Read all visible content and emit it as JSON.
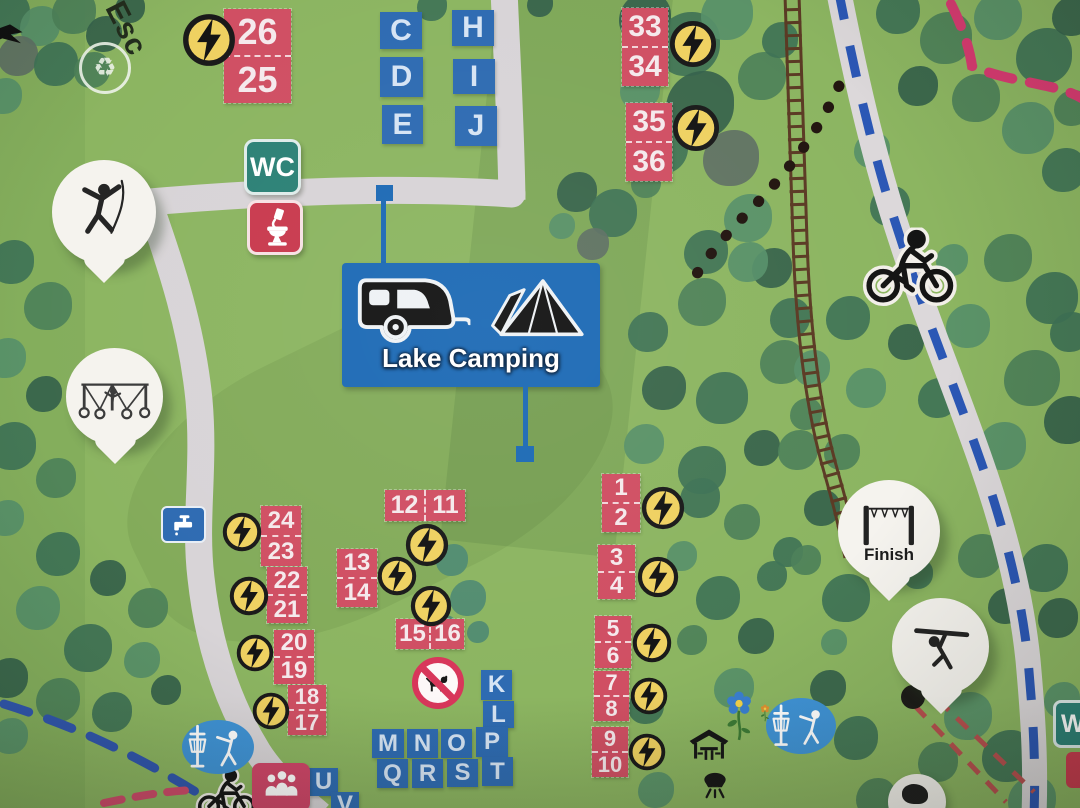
{
  "signs": {
    "lake_camping": "Lake Camping",
    "wc": "WC",
    "wc_partial": "W",
    "finish": "Finish",
    "esc": "Esc"
  },
  "colors": {
    "grass": "#8cb561",
    "path_grey": "#d8d4d7",
    "cycle_blue": "#2b57b5",
    "rail_brown": "#5b3a24",
    "pitch_red": "#d04f63",
    "letter_blue": "#2e6bb2",
    "sign_blue": "#1d6ab5",
    "wc_teal": "#2c8176",
    "toilet_red": "#c93a4e",
    "bolt_yellow": "#efd161",
    "pin_white": "#f5f3ee",
    "trail_pink": "#d63a70",
    "dash_blue": "#3056ae",
    "zip_red": "#b8504f",
    "disc_blue": "#3f93d6",
    "people_pink": "#cf4568",
    "tree_palette": [
      "#4d8159",
      "#3f7356",
      "#579069",
      "#35624b",
      "#5e7064",
      "#4e8a72",
      "#6aa36b"
    ]
  },
  "pitch_groups": [
    {
      "numbers": [
        "26",
        "25"
      ],
      "layout": "v",
      "x": 224,
      "y": 9,
      "w": 67,
      "cell_h": 46,
      "font": 36,
      "bolt": {
        "x": 182,
        "y": 13,
        "d": 54
      }
    },
    {
      "numbers": [
        "33",
        "34"
      ],
      "layout": "v",
      "x": 622,
      "y": 8,
      "w": 46,
      "cell_h": 38,
      "font": 30,
      "bolt": {
        "x": 669,
        "y": 20,
        "d": 48
      }
    },
    {
      "numbers": [
        "35",
        "36"
      ],
      "layout": "v",
      "x": 626,
      "y": 103,
      "w": 46,
      "cell_h": 38,
      "font": 30,
      "bolt": {
        "x": 672,
        "y": 104,
        "d": 48
      }
    },
    {
      "numbers": [
        "24",
        "23"
      ],
      "layout": "v",
      "x": 261,
      "y": 506,
      "w": 40,
      "cell_h": 29,
      "font": 24,
      "bolt": {
        "x": 222,
        "y": 512,
        "d": 40
      }
    },
    {
      "numbers": [
        "22",
        "21"
      ],
      "layout": "v",
      "x": 267,
      "y": 567,
      "w": 40,
      "cell_h": 27,
      "font": 24,
      "bolt": {
        "x": 229,
        "y": 576,
        "d": 40
      }
    },
    {
      "numbers": [
        "20",
        "19"
      ],
      "layout": "v",
      "x": 274,
      "y": 630,
      "w": 40,
      "cell_h": 26,
      "font": 24,
      "bolt": {
        "x": 236,
        "y": 634,
        "d": 38
      }
    },
    {
      "numbers": [
        "18",
        "17"
      ],
      "layout": "v",
      "x": 288,
      "y": 685,
      "w": 38,
      "cell_h": 24,
      "font": 22,
      "bolt": {
        "x": 252,
        "y": 692,
        "d": 38
      }
    },
    {
      "numbers": [
        "13",
        "14"
      ],
      "layout": "v",
      "x": 337,
      "y": 549,
      "w": 40,
      "cell_h": 28,
      "font": 24,
      "bolt": {
        "x": 377,
        "y": 556,
        "d": 40
      }
    },
    {
      "numbers": [
        "1",
        "2"
      ],
      "layout": "v",
      "x": 602,
      "y": 474,
      "w": 38,
      "cell_h": 28,
      "font": 24,
      "bolt": {
        "x": 641,
        "y": 486,
        "d": 44
      }
    },
    {
      "numbers": [
        "3",
        "4"
      ],
      "layout": "v",
      "x": 598,
      "y": 545,
      "w": 37,
      "cell_h": 26,
      "font": 24,
      "bolt": {
        "x": 637,
        "y": 556,
        "d": 42
      }
    },
    {
      "numbers": [
        "5",
        "6"
      ],
      "layout": "v",
      "x": 595,
      "y": 616,
      "w": 36,
      "cell_h": 25,
      "font": 23,
      "bolt": {
        "x": 632,
        "y": 623,
        "d": 40
      }
    },
    {
      "numbers": [
        "7",
        "8"
      ],
      "layout": "v",
      "x": 594,
      "y": 671,
      "w": 35,
      "cell_h": 24,
      "font": 22,
      "bolt": {
        "x": 630,
        "y": 677,
        "d": 38
      }
    },
    {
      "numbers": [
        "9",
        "10"
      ],
      "layout": "v",
      "x": 592,
      "y": 727,
      "w": 36,
      "cell_h": 24,
      "font": 22,
      "bolt": {
        "x": 628,
        "y": 733,
        "d": 38
      }
    },
    {
      "numbers": [
        "12",
        "11"
      ],
      "layout": "h",
      "x": 385,
      "y": 490,
      "cell_w": 39,
      "h": 31,
      "font": 25,
      "bolt": {
        "x": 405,
        "y": 523,
        "d": 44
      }
    },
    {
      "numbers": [
        "15",
        "16"
      ],
      "layout": "h",
      "x": 396,
      "y": 619,
      "cell_w": 33,
      "h": 30,
      "font": 24,
      "bolt": {
        "x": 410,
        "y": 585,
        "d": 42
      }
    }
  ],
  "letter_squares": [
    {
      "ch": "C",
      "x": 380,
      "y": 12,
      "w": 42,
      "h": 37,
      "f": 30
    },
    {
      "ch": "D",
      "x": 380,
      "y": 57,
      "w": 43,
      "h": 40,
      "f": 30
    },
    {
      "ch": "E",
      "x": 382,
      "y": 105,
      "w": 41,
      "h": 39,
      "f": 30
    },
    {
      "ch": "H",
      "x": 452,
      "y": 10,
      "w": 42,
      "h": 36,
      "f": 30
    },
    {
      "ch": "I",
      "x": 453,
      "y": 59,
      "w": 42,
      "h": 35,
      "f": 30
    },
    {
      "ch": "J",
      "x": 455,
      "y": 106,
      "w": 42,
      "h": 40,
      "f": 30
    },
    {
      "ch": "K",
      "x": 481,
      "y": 670,
      "w": 31,
      "h": 30,
      "f": 24
    },
    {
      "ch": "L",
      "x": 483,
      "y": 701,
      "w": 31,
      "h": 27,
      "f": 24
    },
    {
      "ch": "M",
      "x": 372,
      "y": 729,
      "w": 32,
      "h": 29,
      "f": 24
    },
    {
      "ch": "N",
      "x": 407,
      "y": 729,
      "w": 31,
      "h": 29,
      "f": 24
    },
    {
      "ch": "O",
      "x": 441,
      "y": 729,
      "w": 31,
      "h": 29,
      "f": 24
    },
    {
      "ch": "P",
      "x": 476,
      "y": 727,
      "w": 32,
      "h": 30,
      "f": 24
    },
    {
      "ch": "Q",
      "x": 377,
      "y": 759,
      "w": 31,
      "h": 29,
      "f": 24
    },
    {
      "ch": "R",
      "x": 412,
      "y": 759,
      "w": 31,
      "h": 29,
      "f": 24
    },
    {
      "ch": "S",
      "x": 447,
      "y": 759,
      "w": 31,
      "h": 28,
      "f": 24
    },
    {
      "ch": "T",
      "x": 482,
      "y": 757,
      "w": 31,
      "h": 29,
      "f": 24
    },
    {
      "ch": "U",
      "x": 309,
      "y": 768,
      "w": 29,
      "h": 28,
      "f": 24
    },
    {
      "ch": "V",
      "x": 331,
      "y": 792,
      "w": 28,
      "h": 26,
      "f": 24
    }
  ],
  "decor": {
    "trees": [
      [
        8,
        14,
        22,
        1
      ],
      [
        40,
        26,
        20,
        2
      ],
      [
        74,
        12,
        22,
        0
      ],
      [
        104,
        34,
        18,
        3
      ],
      [
        18,
        56,
        20,
        4
      ],
      [
        56,
        64,
        22,
        1
      ],
      [
        92,
        70,
        18,
        0
      ],
      [
        4,
        96,
        18,
        2
      ],
      [
        130,
        8,
        15,
        3
      ],
      [
        432,
        6,
        15,
        1
      ],
      [
        540,
        4,
        13,
        3
      ],
      [
        577,
        192,
        20,
        3
      ],
      [
        613,
        213,
        24,
        1
      ],
      [
        593,
        244,
        16,
        4
      ],
      [
        646,
        183,
        15,
        0
      ],
      [
        562,
        226,
        13,
        2
      ],
      [
        645,
        18,
        26,
        3
      ],
      [
        688,
        44,
        32,
        1
      ],
      [
        727,
        14,
        26,
        2
      ],
      [
        700,
        105,
        34,
        3
      ],
      [
        662,
        148,
        26,
        1
      ],
      [
        731,
        158,
        28,
        4
      ],
      [
        762,
        76,
        24,
        0
      ],
      [
        748,
        218,
        24,
        2
      ],
      [
        706,
        252,
        22,
        1
      ],
      [
        772,
        268,
        20,
        3
      ],
      [
        640,
        90,
        20,
        2
      ],
      [
        780,
        40,
        18,
        1
      ],
      [
        898,
        12,
        22,
        1
      ],
      [
        946,
        38,
        26,
        0
      ],
      [
        998,
        16,
        24,
        2
      ],
      [
        1044,
        56,
        28,
        1
      ],
      [
        1072,
        16,
        20,
        3
      ],
      [
        976,
        98,
        24,
        0
      ],
      [
        1028,
        128,
        26,
        2
      ],
      [
        1064,
        170,
        22,
        1
      ],
      [
        918,
        86,
        20,
        3
      ],
      [
        872,
        150,
        18,
        2
      ],
      [
        890,
        206,
        20,
        1
      ],
      [
        1072,
        108,
        18,
        0
      ],
      [
        1008,
        258,
        24,
        0
      ],
      [
        1052,
        298,
        26,
        1
      ],
      [
        968,
        326,
        22,
        2
      ],
      [
        1032,
        378,
        28,
        0
      ],
      [
        1068,
        420,
        24,
        3
      ],
      [
        938,
        398,
        20,
        1
      ],
      [
        1002,
        446,
        24,
        2
      ],
      [
        906,
        342,
        18,
        3
      ],
      [
        848,
        318,
        22,
        1
      ],
      [
        866,
        388,
        20,
        2
      ],
      [
        842,
        452,
        18,
        0
      ],
      [
        1070,
        332,
        20,
        1
      ],
      [
        952,
        260,
        16,
        2
      ],
      [
        648,
        332,
        20,
        1
      ],
      [
        702,
        302,
        24,
        0
      ],
      [
        748,
        262,
        20,
        2
      ],
      [
        664,
        388,
        22,
        3
      ],
      [
        722,
        398,
        26,
        1
      ],
      [
        782,
        362,
        22,
        0
      ],
      [
        644,
        444,
        20,
        2
      ],
      [
        702,
        470,
        24,
        1
      ],
      [
        762,
        448,
        18,
        3
      ],
      [
        806,
        414,
        16,
        0
      ],
      [
        452,
        560,
        16,
        5
      ],
      [
        468,
        598,
        18,
        5
      ],
      [
        444,
        628,
        13,
        5
      ],
      [
        478,
        632,
        11,
        5
      ],
      [
        700,
        498,
        20,
        1
      ],
      [
        742,
        522,
        18,
        0
      ],
      [
        682,
        556,
        15,
        2
      ],
      [
        718,
        598,
        22,
        1
      ],
      [
        756,
        636,
        18,
        3
      ],
      [
        692,
        640,
        15,
        0
      ],
      [
        734,
        688,
        20,
        2
      ],
      [
        772,
        576,
        15,
        1
      ],
      [
        790,
        318,
        20,
        1
      ],
      [
        812,
        368,
        18,
        2
      ],
      [
        798,
        450,
        20,
        0
      ],
      [
        822,
        508,
        18,
        3
      ],
      [
        788,
        552,
        15,
        1
      ],
      [
        846,
        598,
        24,
        1
      ],
      [
        888,
        556,
        20,
        2
      ],
      [
        980,
        556,
        22,
        0
      ],
      [
        1044,
        568,
        24,
        1
      ],
      [
        1058,
        618,
        20,
        3
      ],
      [
        968,
        716,
        24,
        2
      ],
      [
        1008,
        756,
        26,
        1
      ],
      [
        938,
        762,
        20,
        0
      ],
      [
        1062,
        700,
        18,
        2
      ],
      [
        856,
        738,
        22,
        1
      ],
      [
        828,
        688,
        18,
        3
      ],
      [
        876,
        798,
        20,
        0
      ],
      [
        1032,
        800,
        24,
        2
      ],
      [
        918,
        574,
        15,
        1
      ],
      [
        806,
        560,
        15,
        0
      ],
      [
        1006,
        606,
        18,
        3
      ],
      [
        834,
        642,
        13,
        2
      ],
      [
        12,
        262,
        22,
        1
      ],
      [
        48,
        306,
        24,
        0
      ],
      [
        6,
        358,
        20,
        2
      ],
      [
        44,
        394,
        18,
        3
      ],
      [
        12,
        446,
        24,
        1
      ],
      [
        56,
        478,
        20,
        0
      ],
      [
        6,
        518,
        18,
        2
      ],
      [
        58,
        554,
        22,
        1
      ],
      [
        108,
        578,
        18,
        3
      ],
      [
        148,
        608,
        20,
        0
      ],
      [
        38,
        608,
        22,
        2
      ],
      [
        88,
        648,
        24,
        1
      ],
      [
        8,
        678,
        20,
        3
      ],
      [
        142,
        660,
        18,
        2
      ],
      [
        58,
        700,
        22,
        0
      ],
      [
        112,
        712,
        20,
        1
      ],
      [
        166,
        690,
        15,
        3
      ],
      [
        10,
        736,
        18,
        2
      ],
      [
        646,
        706,
        18,
        1
      ],
      [
        656,
        790,
        18,
        2
      ]
    ]
  }
}
